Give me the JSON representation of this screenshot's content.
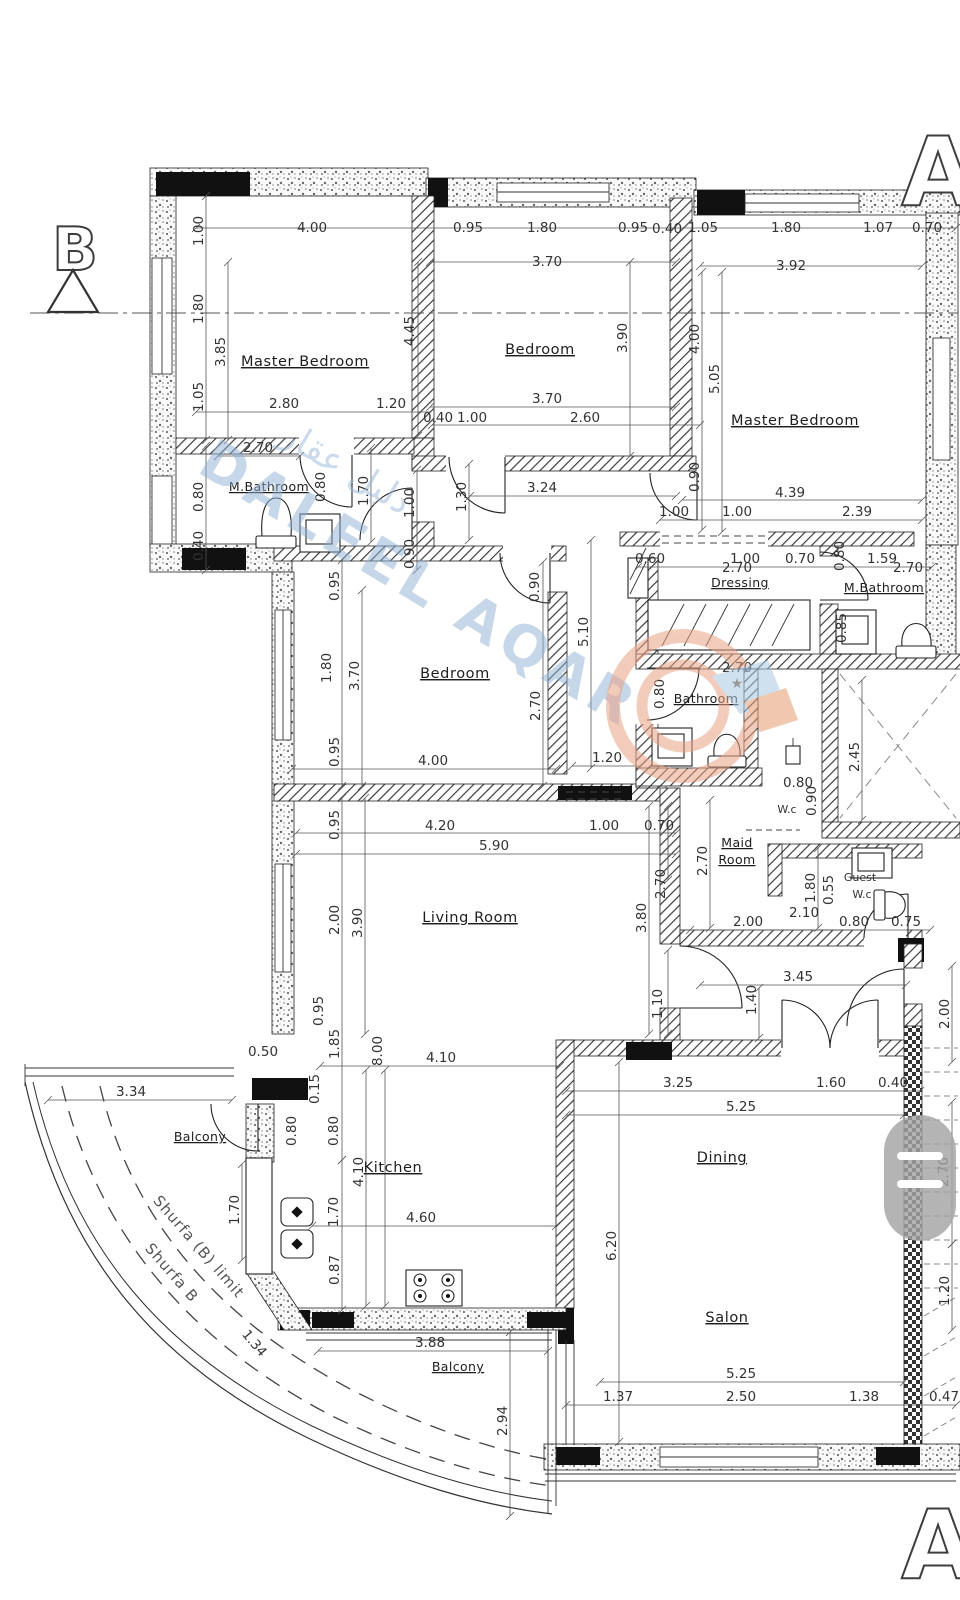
{
  "section_markers": {
    "b": "B",
    "a_top": "A",
    "a_bottom": "A"
  },
  "watermark": {
    "brand": "DALEEL AQAR",
    "brand_arabic": "دليل عقار"
  },
  "colors": {
    "watermark_blue": "#8fb0d4",
    "logo_orange": "#e9a285",
    "ribbon_blue": "#a9c8e2",
    "pill_gray": "#a3a3a3"
  },
  "rooms": {
    "master_bedroom_left": "Master Bedroom",
    "bedroom_top": "Bedroom",
    "master_bedroom_right": "Master Bedroom",
    "m_bathroom_left": "M.Bathroom",
    "bedroom_middle": "Bedroom",
    "dressing": "Dressing",
    "m_bathroom_right": "M.Bathroom",
    "bathroom": "Bathroom",
    "maid_line1": "Maid",
    "maid_line2": "Room",
    "wc": "W.c",
    "guest_line1": "Guest",
    "guest_line2": "W.c",
    "living_room": "Living Room",
    "kitchen": "Kitchen",
    "balcony_left": "Balcony",
    "dining": "Dining",
    "salon": "Salon",
    "balcony_bottom": "Balcony"
  },
  "annotations": {
    "shurfa_limit": "Shurfa (B) limit",
    "shurfa_b": "Shurfa B"
  },
  "dims": [
    "4.00",
    "0.95",
    "1.80",
    "0.95",
    "0.40",
    "1.05",
    "1.80",
    "1.07",
    "0.70",
    "3.70",
    "3.92",
    "1.00",
    "1.80",
    "3.85",
    "1.05",
    "4.45",
    "3.90",
    "4.00",
    "5.05",
    "2.80",
    "1.20",
    "3.70",
    "0.40",
    "1.00",
    "2.60",
    "2.70",
    "0.80",
    "0.40",
    "0.80",
    "1.70",
    "1.00",
    "0.90",
    "1.30",
    "3.24",
    "4.39",
    "1.00",
    "1.00",
    "2.39",
    "0.90",
    "0.60",
    "1.00",
    "0.70",
    "1.59",
    "2.70",
    "2.70",
    "0.80",
    "0.85",
    "0.95",
    "1.80",
    "3.70",
    "5.10",
    "0.90",
    "2.70",
    "2.70",
    "0.80",
    "4.00",
    "1.20",
    "0.95",
    "2.45",
    "0.80",
    "0.90",
    "2.70",
    "2.70",
    "1.80",
    "0.55",
    "4.20",
    "1.00",
    "0.70",
    "5.90",
    "0.95",
    "2.00",
    "3.90",
    "3.80",
    "1.10",
    "2.00",
    "2.10",
    "0.80",
    "0.75",
    "3.45",
    "1.40",
    "2.00",
    "3.25",
    "1.60",
    "0.40",
    "5.25",
    "6.20",
    "2.70",
    "1.20",
    "0.95",
    "1.85",
    "8.00",
    "4.10",
    "0.50",
    "0.15",
    "0.80",
    "0.80",
    "4.10",
    "1.70",
    "1.70",
    "4.60",
    "0.87",
    "3.34",
    "3.88",
    "2.94",
    "1.34",
    "5.25",
    "1.37",
    "2.50",
    "1.38",
    "0.47"
  ]
}
